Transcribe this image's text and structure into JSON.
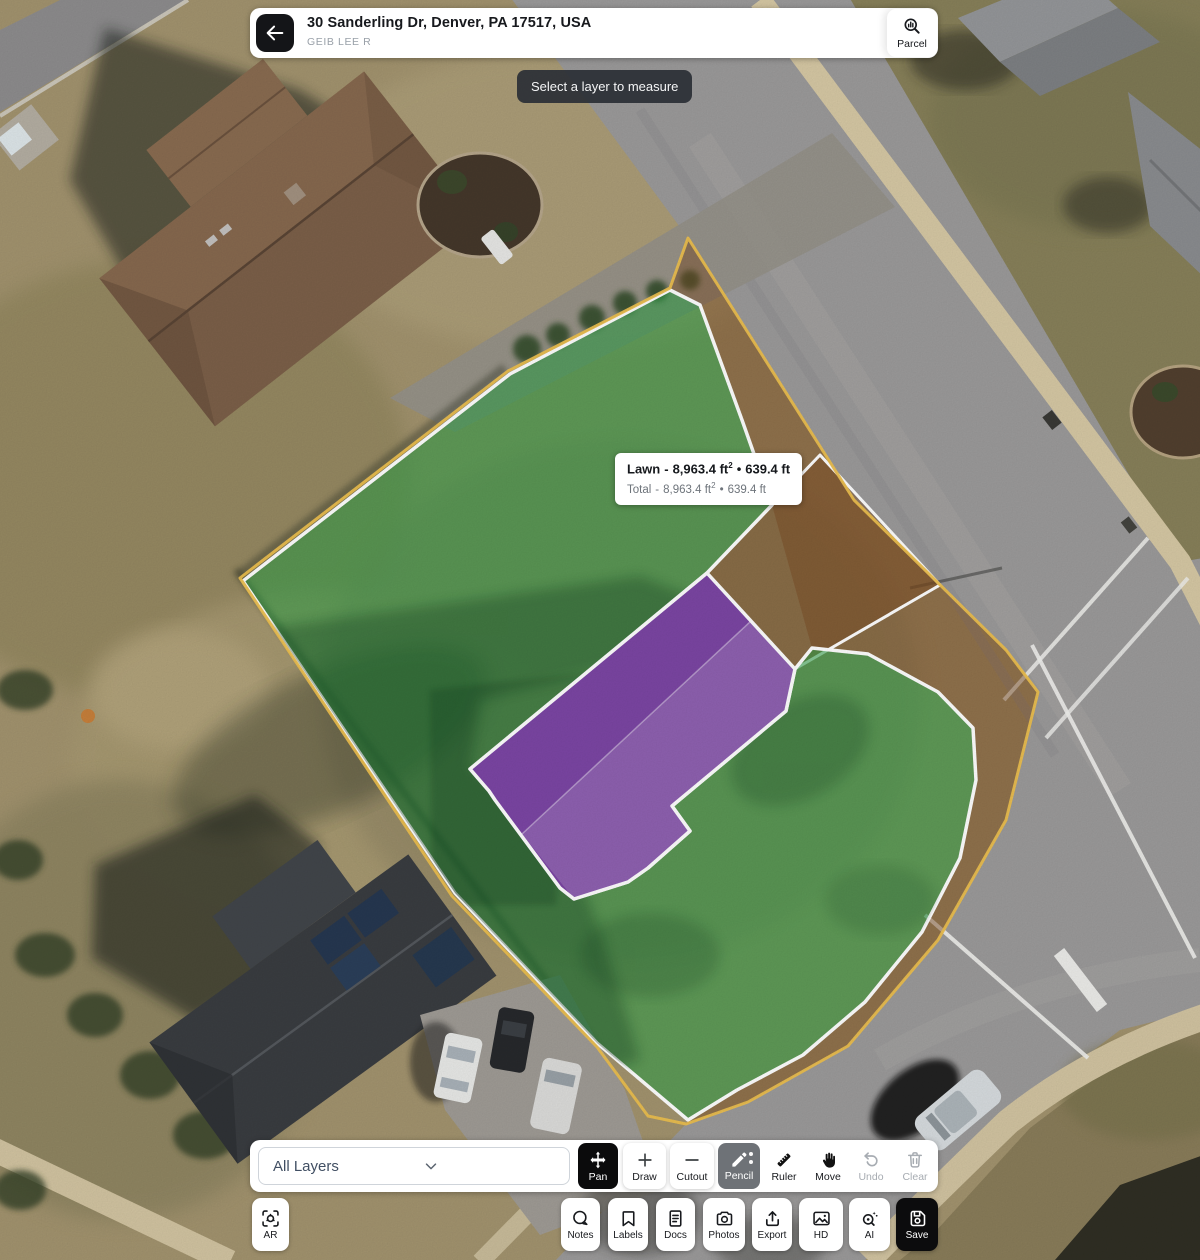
{
  "header": {
    "title": "30 Sanderling Dr, Denver, PA 17517, USA",
    "subtitle": "GEIB LEE R",
    "parcel_label": "Parcel"
  },
  "tooltip": {
    "text": "Select a layer to measure"
  },
  "measurement": {
    "layer_label": "Lawn",
    "dash": "-",
    "area": "8,963.4 ft",
    "area_exp": "2",
    "bullet": "•",
    "perimeter": "639.4 ft",
    "total_label": "Total",
    "total_dash": "-",
    "total_area": "8,963.4 ft",
    "total_area_exp": "2",
    "total_bullet": "•",
    "total_perimeter": "639.4 ft"
  },
  "toolbar": {
    "layers_dropdown": {
      "value": "All Layers"
    },
    "tools": [
      {
        "id": "pan",
        "label": "Pan"
      },
      {
        "id": "draw",
        "label": "Draw"
      },
      {
        "id": "cutout",
        "label": "Cutout"
      },
      {
        "id": "pencil",
        "label": "Pencil"
      },
      {
        "id": "ruler",
        "label": "Ruler"
      },
      {
        "id": "move",
        "label": "Move"
      },
      {
        "id": "undo",
        "label": "Undo"
      },
      {
        "id": "clear",
        "label": "Clear"
      }
    ]
  },
  "action_bar": {
    "ar_label": "AR",
    "buttons": [
      {
        "id": "notes",
        "label": "Notes"
      },
      {
        "id": "labels",
        "label": "Labels"
      },
      {
        "id": "docs",
        "label": "Docs"
      },
      {
        "id": "photos",
        "label": "Photos"
      },
      {
        "id": "export",
        "label": "Export"
      },
      {
        "id": "hd",
        "label": "HD"
      },
      {
        "id": "ai",
        "label": "AI"
      },
      {
        "id": "save",
        "label": "Save"
      }
    ]
  },
  "map": {
    "overlay_colors": {
      "lawn": "#2f9e47",
      "roof": "#7634b4",
      "pavement": "#7a4a22",
      "parcel_line": "#edc04f"
    }
  }
}
